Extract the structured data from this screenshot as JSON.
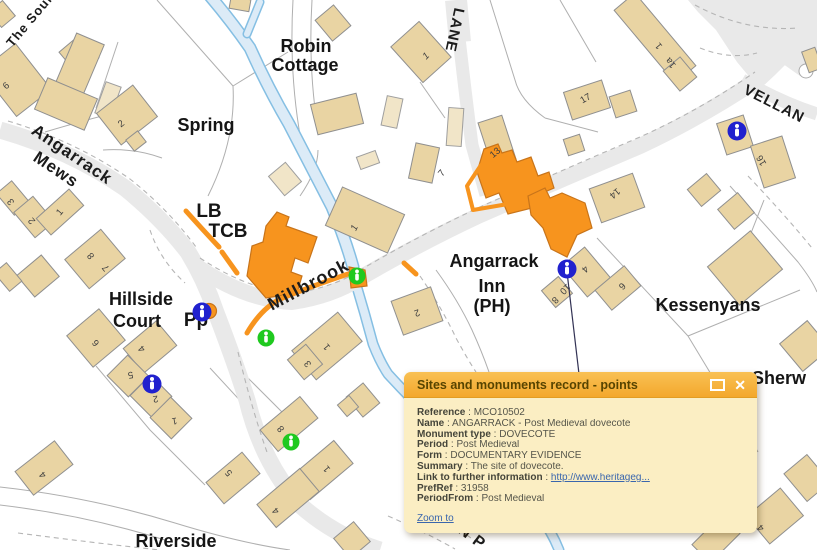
{
  "popup": {
    "title": "Sites and monuments record - points",
    "separator": " : ",
    "icons": {
      "close": "✕",
      "maximize": "maximize-box"
    },
    "fields": [
      {
        "label": "Reference",
        "value": "MCO10502"
      },
      {
        "label": "Name",
        "value": "ANGARRACK - Post Medieval dovecote"
      },
      {
        "label": "Monument type",
        "value": "DOVECOTE"
      },
      {
        "label": "Period",
        "value": "Post Medieval"
      },
      {
        "label": "Form",
        "value": "DOCUMENTARY EVIDENCE"
      },
      {
        "label": "Summary",
        "value": "The site of dovecote."
      },
      {
        "label": "Link to further information",
        "value": "http://www.heritageg..."
      },
      {
        "label": "PrefRef",
        "value": "31958"
      },
      {
        "label": "PeriodFrom",
        "value": "Post Medieval"
      }
    ],
    "zoom_to_label": "Zoom to",
    "colors": {
      "header": "#F5AF33",
      "body": "#FBEEC3",
      "link": "#3A66AD"
    }
  },
  "map": {
    "place_labels": [
      {
        "text": "Robin"
      },
      {
        "text": "Cottage"
      },
      {
        "text": "Spring"
      },
      {
        "text": "Hillside"
      },
      {
        "text": "Court"
      },
      {
        "text": "LB"
      },
      {
        "text": "TCB"
      },
      {
        "text": "Pp"
      },
      {
        "text": "Angarrack"
      },
      {
        "text": "Inn"
      },
      {
        "text": "(PH)"
      },
      {
        "text": "Kessenyans"
      },
      {
        "text": "Sherw"
      },
      {
        "text": "Riverside"
      }
    ],
    "road_labels": [
      {
        "text": "The Soun"
      },
      {
        "text": "Angarrack"
      },
      {
        "text": "Mews"
      },
      {
        "text": "LANE"
      },
      {
        "text": "VELLAN"
      },
      {
        "text": "Millbrook"
      },
      {
        "text": "AN P"
      }
    ],
    "numbers": [
      {
        "t": "6"
      },
      {
        "t": "2"
      },
      {
        "t": "1"
      },
      {
        "t": "13"
      },
      {
        "t": "7"
      },
      {
        "t": "17"
      },
      {
        "t": "1"
      },
      {
        "t": "1a"
      },
      {
        "t": "16"
      },
      {
        "t": "3"
      },
      {
        "t": "2"
      },
      {
        "t": "1"
      },
      {
        "t": "8"
      },
      {
        "t": "7"
      },
      {
        "t": "6"
      },
      {
        "t": "4"
      },
      {
        "t": "1"
      },
      {
        "t": "2"
      },
      {
        "t": "1"
      },
      {
        "t": "3"
      },
      {
        "t": "14"
      },
      {
        "t": "4"
      },
      {
        "t": "6"
      },
      {
        "t": "8"
      },
      {
        "t": "10"
      },
      {
        "t": "5"
      },
      {
        "t": "2"
      },
      {
        "t": "1"
      },
      {
        "t": "4"
      },
      {
        "t": "5"
      },
      {
        "t": "8"
      },
      {
        "t": "1"
      },
      {
        "t": "4"
      },
      {
        "t": "4"
      }
    ],
    "icons": {
      "info_glyph": "i"
    },
    "colors": {
      "highlight_orange": "#F7941E",
      "building_tan": "#E9D4A3",
      "building_light": "#F1E5C8",
      "road_gray": "#E9E9E9",
      "stream_fill": "#DCEBF7",
      "stream_edge": "#85BFE3",
      "marker_blue": "#2121CE",
      "marker_green": "#1FC91F"
    }
  }
}
